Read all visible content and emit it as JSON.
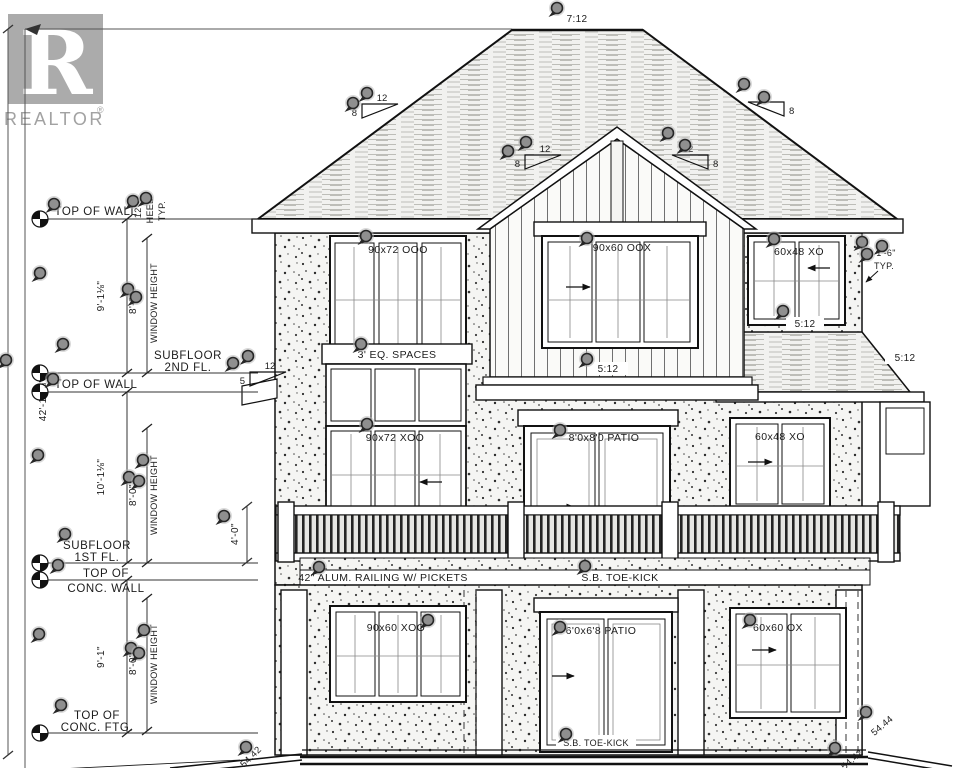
{
  "logo": {
    "letter": "R",
    "name": "REALTOR",
    "reg": "®"
  },
  "roof": {
    "main_pitch": "7:12"
  },
  "pitch_triangles": {
    "left": {
      "run": "12",
      "rise": "8"
    },
    "gable_left": {
      "run": "12",
      "rise": "8"
    },
    "gable_right": {
      "run": "12",
      "rise": "8"
    },
    "right": {
      "run": "12",
      "rise": "8"
    },
    "pent_left": {
      "run": "12",
      "rise": "5"
    }
  },
  "pitch_labels": {
    "gable_base": "5:12",
    "right_wall": "5:12",
    "far_right": "5:12"
  },
  "elevation_marks": {
    "top_of_wall_2nd": "TOP OF WALL",
    "subfloor_2nd_1": "SUBFLOOR",
    "subfloor_2nd_2": "2ND FL.",
    "top_of_wall_1st": "TOP OF WALL",
    "subfloor_1st_1": "SUBFLOOR",
    "subfloor_1st_2": "1ST FL.",
    "top_conc_wall_1": "TOP OF",
    "top_conc_wall_2": "CONC. WALL",
    "top_conc_ftg_1": "TOP OF",
    "top_conc_ftg_2": "CONC. FTG."
  },
  "dimensions": {
    "overall_height": "42'-10⅞\"",
    "second_floor": "9'-1⅛\"",
    "first_floor": "10'-1⅛\"",
    "basement": "9'-1\"",
    "window_height": "8'-0\"",
    "window_height_label": "WINDOW HEIGHT",
    "heel": "12\"",
    "heel_label_1": "HEEL",
    "heel_label_2": "TYP.",
    "railing_height": "4'-0\"",
    "overhang": "1'-6\"",
    "overhang_typ": "TYP."
  },
  "windows": {
    "upper_left": "90x72 OOO",
    "gable": "90x60 OOX",
    "upper_right": "60x48 XO",
    "transom_header": "3' EQ. SPACES",
    "main_left": "90x72 XOO",
    "main_patio": "8'0x8'0 PATIO",
    "main_right": "60x48 XO",
    "basement_left": "90x60 XOO",
    "basement_patio": "6'0x6'8 PATIO",
    "basement_right": "60x60 OX"
  },
  "deck": {
    "railing_label": "42\" ALUM. RAILING W/ PICKETS",
    "toe_kick": "S.B. TOE-KICK",
    "toe_kick_bottom": "S.B. TOE-KICK"
  },
  "grade": {
    "right_upper": "54.44",
    "right_lower": "54.42",
    "left": "54.42"
  },
  "annotation_pins": [
    [
      557,
      8
    ],
    [
      353,
      103
    ],
    [
      367,
      93
    ],
    [
      526,
      142
    ],
    [
      508,
      151
    ],
    [
      668,
      133
    ],
    [
      685,
      145
    ],
    [
      744,
      84
    ],
    [
      764,
      97
    ],
    [
      54,
      204
    ],
    [
      133,
      201
    ],
    [
      146,
      198
    ],
    [
      40,
      273
    ],
    [
      128,
      289
    ],
    [
      136,
      297
    ],
    [
      6,
      360
    ],
    [
      63,
      344
    ],
    [
      53,
      379
    ],
    [
      248,
      356
    ],
    [
      233,
      363
    ],
    [
      361,
      344
    ],
    [
      367,
      424
    ],
    [
      366,
      236
    ],
    [
      587,
      238
    ],
    [
      774,
      239
    ],
    [
      862,
      242
    ],
    [
      882,
      246
    ],
    [
      867,
      254
    ],
    [
      783,
      311
    ],
    [
      587,
      359
    ],
    [
      560,
      430
    ],
    [
      38,
      455
    ],
    [
      143,
      460
    ],
    [
      129,
      477
    ],
    [
      139,
      481
    ],
    [
      65,
      534
    ],
    [
      58,
      565
    ],
    [
      224,
      516
    ],
    [
      319,
      567
    ],
    [
      585,
      566
    ],
    [
      39,
      634
    ],
    [
      144,
      630
    ],
    [
      131,
      648
    ],
    [
      139,
      653
    ],
    [
      61,
      705
    ],
    [
      560,
      627
    ],
    [
      428,
      620
    ],
    [
      750,
      620
    ],
    [
      866,
      712
    ],
    [
      835,
      748
    ],
    [
      246,
      747
    ],
    [
      566,
      734
    ]
  ]
}
